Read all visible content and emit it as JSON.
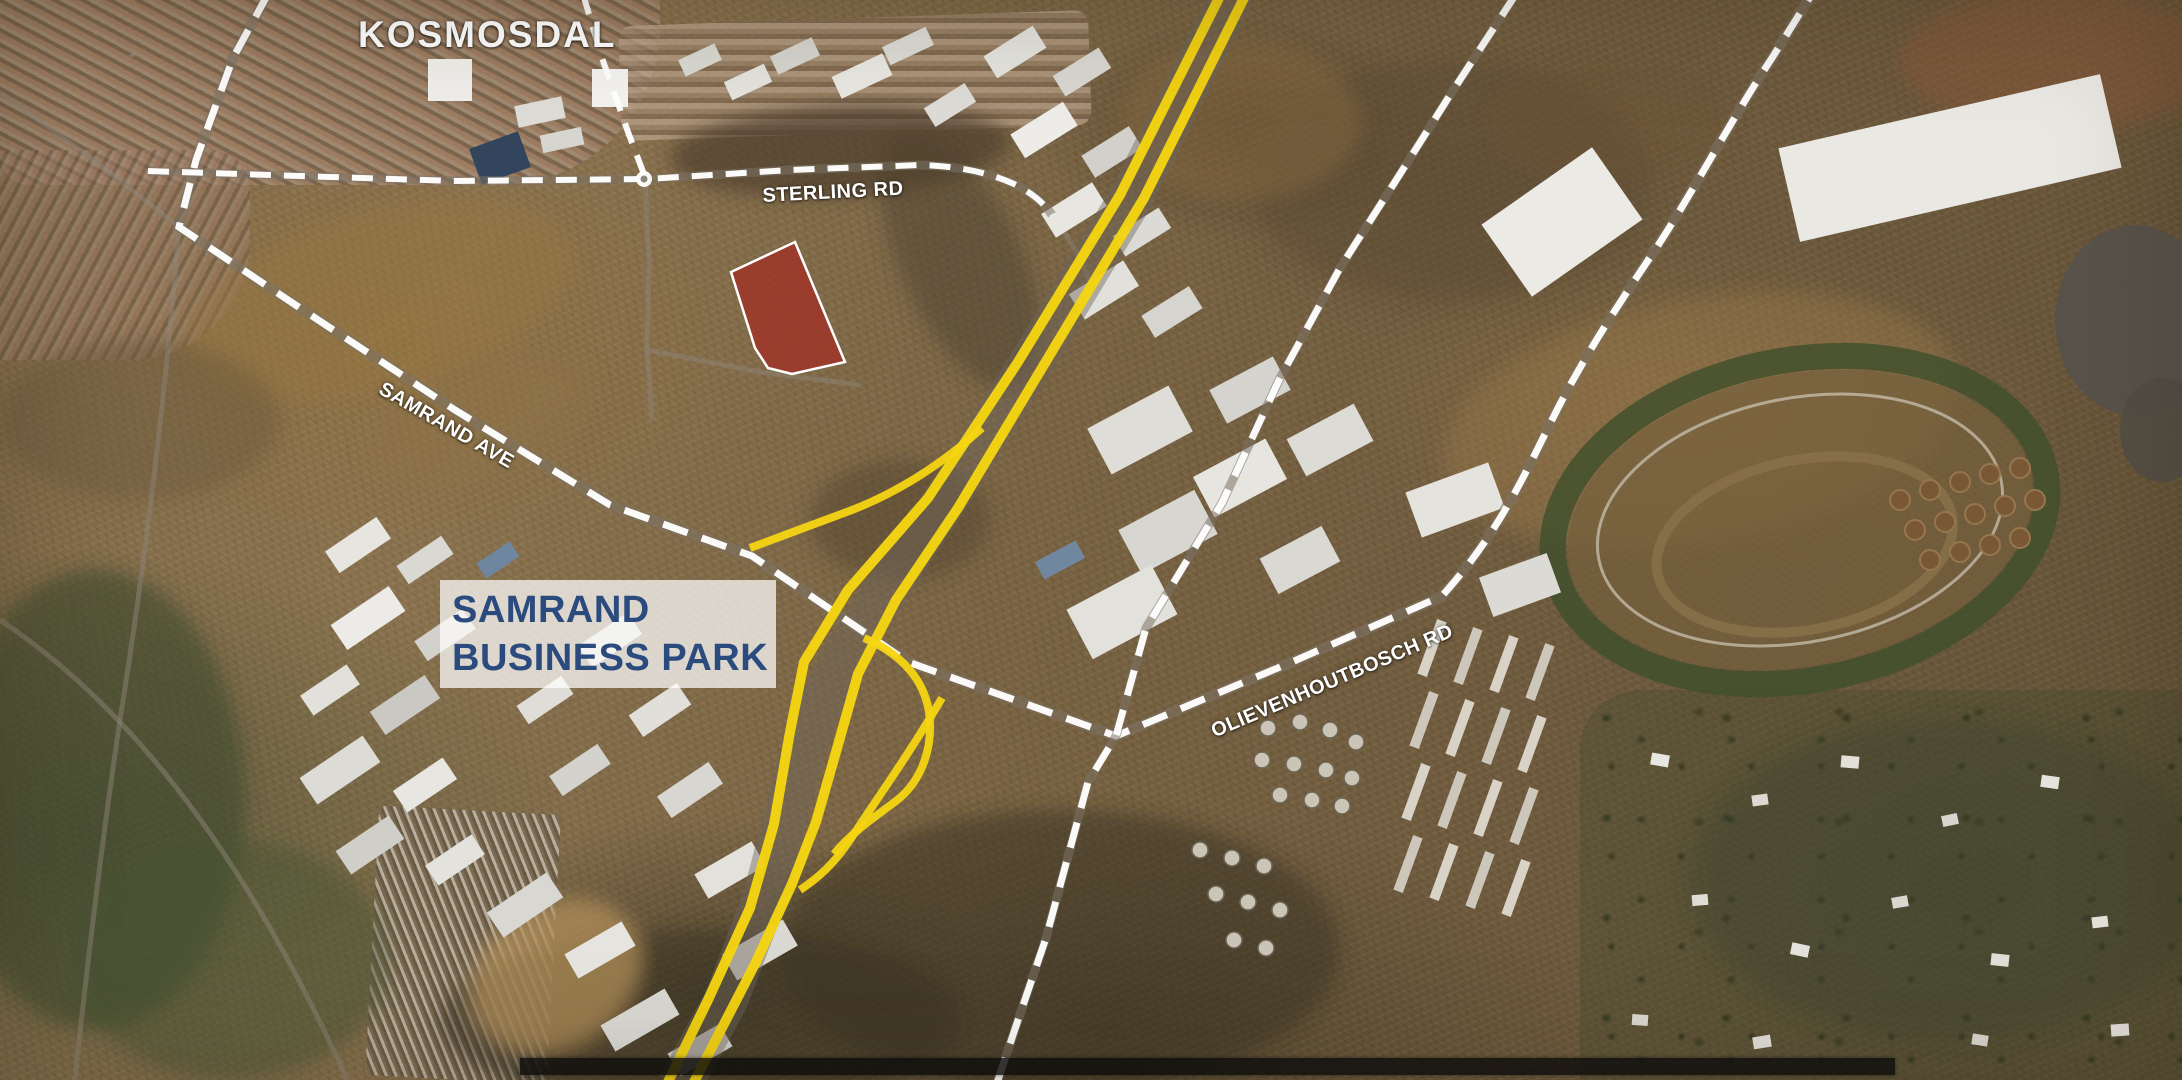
{
  "map": {
    "labels": {
      "kosmosdal": "KOSMOSDAL",
      "sterling_rd": "STERLING RD",
      "samrand_ave": "SAMRAND AVE",
      "olievenhoutbosch_rd": "OLIEVENHOUTBOSCH RD",
      "business_park_line1": "SAMRAND",
      "business_park_line2": "BUSINESS PARK"
    },
    "colors": {
      "highway_yellow": "#F5D512",
      "road_dash_white": "#FFFFFF",
      "site_fill_red": "#A13227",
      "site_border_white": "#FFFFFF",
      "business_park_text_navy": "#2B4A7E",
      "label_white": "#FFFFFF",
      "bottom_bar_black": "#0C0C0C"
    },
    "geometry": {
      "site_polygon": "795,242 845,362 792,374 768,368 755,348 731,272",
      "road_main": "M268,-6 L233,58 L196,160 L179,227 L300,308 L455,410 L610,505 L752,556 L908,662 L1116,736 L1292,662 L1442,596 C1492,540 1515,495 1548,428 C1580,362 1618,305 1655,250 C1692,194 1732,118 1772,58 L1812,-6",
      "road_sterling": "M148,171 L300,176 L455,181 L648,179 L790,170 L920,165 C960,166 990,173 1014,184 C1032,193 1044,203 1052,215",
      "road_north": "M1516,-6 L1452,92 L1400,174 L1340,268 L1280,378 L1222,503 L1146,628 L1116,736 L1088,782 L1046,938 L1016,1026 L996,1086",
      "road_d": "M583,-6 L602,58 L628,132 L645,177",
      "n1_under": "M1234,-8 L1132,196 L1030,365 L944,502 C900,570 865,620 840,665 C815,710 800,760 790,800 L764,900 L726,1000 L679,1086",
      "n1_west": "M1222,-8 L1120,195 L1018,362 L928,498 L848,590 L804,662 L790,732 L774,824 L750,908 L708,1000 L666,1086",
      "n1_east": "M1247,-8 L1144,198 L1042,368 L958,508 L896,600 L858,674 L836,752 L816,822 L792,884 L756,962 L692,1086",
      "ramp_west": "M982,428 C940,466 898,492 852,510 C818,523 784,535 750,548",
      "ramp_hook": "M864,638 C902,654 924,680 929,712 C934,748 921,782 896,801 C872,819 850,834 834,854",
      "ramp_se": "M942,698 C908,756 876,800 850,840 C834,864 818,878 800,890",
      "grey1": "M0,92 L100,165 L179,227",
      "grey2": "M179,227 C170,340 152,520 120,720 C102,840 88,960 74,1086",
      "grey3": "M645,177 L649,265 L647,350 L652,420",
      "grey4": "M647,350 L760,372 L860,385",
      "grey5": "M0,620 C120,700 240,840 350,1086",
      "grey6": "M1052,215 C1075,245 1090,275 1098,310"
    },
    "buildings": {
      "industrial": [
        [
          358,
          545,
          62,
          26,
          -34,
          "#e6e5e0"
        ],
        [
          425,
          560,
          54,
          22,
          -34,
          "#d9d8d2"
        ],
        [
          368,
          618,
          70,
          30,
          -34,
          "#ecebe7"
        ],
        [
          445,
          635,
          58,
          24,
          -34,
          "#d2d1cb"
        ],
        [
          330,
          690,
          56,
          24,
          -34,
          "#e1e0da"
        ],
        [
          405,
          705,
          66,
          28,
          -34,
          "#c9c8c2"
        ],
        [
          340,
          770,
          76,
          32,
          -34,
          "#dcdbd5"
        ],
        [
          425,
          785,
          60,
          26,
          -34,
          "#e7e6e1"
        ],
        [
          370,
          845,
          64,
          28,
          -34,
          "#cfcec8"
        ],
        [
          455,
          860,
          56,
          24,
          -34,
          "#e3e2dd"
        ],
        [
          498,
          560,
          40,
          18,
          -34,
          "#6e86a0"
        ],
        [
          545,
          700,
          54,
          22,
          -34,
          "#deddd7"
        ],
        [
          580,
          770,
          58,
          24,
          -34,
          "#d3d2cc"
        ],
        [
          610,
          640,
          60,
          26,
          -34,
          "#d5d4ce"
        ],
        [
          660,
          710,
          58,
          26,
          -34,
          "#e0dfd9"
        ],
        [
          690,
          790,
          62,
          26,
          -34,
          "#d7d6d0"
        ],
        [
          730,
          870,
          66,
          28,
          -30,
          "#e2e1dc"
        ],
        [
          760,
          950,
          70,
          30,
          -30,
          "#d9d8d2"
        ],
        [
          525,
          905,
          72,
          30,
          -34,
          "#d8d7d1"
        ],
        [
          600,
          950,
          66,
          28,
          -30,
          "#e5e4df"
        ],
        [
          640,
          1020,
          74,
          30,
          -30,
          "#dad9d3"
        ],
        [
          700,
          1050,
          60,
          26,
          -30,
          "#d1d0ca"
        ],
        [
          450,
          80,
          44,
          42,
          0,
          "#efeeea"
        ],
        [
          610,
          88,
          36,
          38,
          0,
          "#f3f2ee"
        ],
        [
          540,
          112,
          48,
          22,
          -12,
          "#dddcd6"
        ],
        [
          562,
          140,
          42,
          18,
          -12,
          "#d6d5cf"
        ],
        [
          500,
          158,
          52,
          38,
          -20,
          "#32455c"
        ],
        [
          700,
          60,
          40,
          18,
          -25,
          "#d9d8d2"
        ],
        [
          748,
          82,
          44,
          20,
          -25,
          "#e4e3de"
        ],
        [
          795,
          56,
          46,
          20,
          -25,
          "#d5d4ce"
        ],
        [
          862,
          76,
          56,
          24,
          -25,
          "#e8e7e2"
        ],
        [
          908,
          46,
          48,
          20,
          -25,
          "#dcdbd5"
        ],
        [
          1015,
          52,
          58,
          26,
          -32,
          "#e4e3de"
        ],
        [
          1082,
          72,
          54,
          24,
          -32,
          "#d8d7d1"
        ],
        [
          1044,
          130,
          62,
          28,
          -32,
          "#edece8"
        ],
        [
          1112,
          152,
          56,
          26,
          -32,
          "#d1d0ca"
        ],
        [
          1074,
          210,
          60,
          28,
          -32,
          "#e7e6e1"
        ],
        [
          1142,
          232,
          54,
          24,
          -32,
          "#dbdad4"
        ],
        [
          1104,
          290,
          64,
          30,
          -32,
          "#e1e0db"
        ],
        [
          1172,
          312,
          56,
          26,
          -32,
          "#d5d4cf"
        ],
        [
          950,
          105,
          48,
          22,
          -32,
          "#dcdbd5"
        ],
        [
          1140,
          430,
          92,
          52,
          -28,
          "#deddd7"
        ],
        [
          1240,
          478,
          82,
          46,
          -28,
          "#e6e5e0"
        ],
        [
          1168,
          532,
          86,
          50,
          -28,
          "#d7d6d0"
        ],
        [
          1122,
          612,
          96,
          56,
          -28,
          "#e2e1dc"
        ],
        [
          1250,
          390,
          72,
          38,
          -28,
          "#d4d3cd"
        ],
        [
          1330,
          440,
          76,
          42,
          -28,
          "#dcdbd5"
        ],
        [
          1300,
          560,
          70,
          40,
          -28,
          "#d9d8d2"
        ],
        [
          1060,
          560,
          46,
          20,
          -28,
          "#70889f"
        ],
        [
          1562,
          222,
          135,
          88,
          -35,
          "#eceae5"
        ],
        [
          1950,
          158,
          330,
          96,
          -13,
          "#eae8e3"
        ],
        [
          1455,
          500,
          88,
          48,
          -20,
          "#e5e3de"
        ],
        [
          1520,
          585,
          72,
          42,
          -20,
          "#dcdad5"
        ],
        [
          1660,
          760,
          18,
          12,
          10,
          "#e8e6e0"
        ],
        [
          1760,
          800,
          16,
          11,
          -8,
          "#ddd9d2"
        ],
        [
          1850,
          762,
          18,
          12,
          5,
          "#e3e0da"
        ],
        [
          1950,
          820,
          16,
          11,
          -12,
          "#d8d5ce"
        ],
        [
          2050,
          782,
          18,
          12,
          8,
          "#e6e3dd"
        ],
        [
          1700,
          900,
          16,
          11,
          -5,
          "#dfdcd5"
        ],
        [
          1800,
          950,
          18,
          12,
          12,
          "#e4e1db"
        ],
        [
          1900,
          902,
          16,
          11,
          -10,
          "#dad7d0"
        ],
        [
          2000,
          960,
          18,
          12,
          6,
          "#e1ded8"
        ],
        [
          2100,
          922,
          16,
          11,
          -7,
          "#e7e4de"
        ],
        [
          1640,
          1020,
          16,
          11,
          4,
          "#dcd9d2"
        ],
        [
          1762,
          1042,
          18,
          12,
          -9,
          "#e2dfd9"
        ],
        [
          1980,
          1040,
          16,
          11,
          9,
          "#d9d6cf"
        ],
        [
          2120,
          1030,
          18,
          12,
          -4,
          "#e5e2dc"
        ],
        [
          1432,
          648,
          10,
          58,
          20,
          "#d9d3c7"
        ],
        [
          1468,
          656,
          10,
          58,
          20,
          "#cdc7bb"
        ],
        [
          1504,
          664,
          10,
          58,
          20,
          "#d9d3c7"
        ],
        [
          1540,
          672,
          10,
          58,
          20,
          "#cdc7bb"
        ],
        [
          1424,
          720,
          10,
          58,
          20,
          "#cdc7bb"
        ],
        [
          1460,
          728,
          10,
          58,
          20,
          "#d9d3c7"
        ],
        [
          1496,
          736,
          10,
          58,
          20,
          "#cdc7bb"
        ],
        [
          1532,
          744,
          10,
          58,
          20,
          "#d9d3c7"
        ],
        [
          1416,
          792,
          10,
          58,
          20,
          "#d9d3c7"
        ],
        [
          1452,
          800,
          10,
          58,
          20,
          "#cdc7bb"
        ],
        [
          1488,
          808,
          10,
          58,
          20,
          "#d9d3c7"
        ],
        [
          1524,
          816,
          10,
          58,
          20,
          "#cdc7bb"
        ],
        [
          1408,
          864,
          10,
          58,
          20,
          "#cdc7bb"
        ],
        [
          1444,
          872,
          10,
          58,
          20,
          "#d9d3c7"
        ],
        [
          1480,
          880,
          10,
          58,
          20,
          "#cdc7bb"
        ],
        [
          1516,
          888,
          10,
          58,
          20,
          "#d9d3c7"
        ]
      ],
      "huts": [
        [
          1268,
          728
        ],
        [
          1300,
          722
        ],
        [
          1330,
          730
        ],
        [
          1356,
          742
        ],
        [
          1262,
          760
        ],
        [
          1294,
          764
        ],
        [
          1326,
          770
        ],
        [
          1352,
          778
        ],
        [
          1280,
          795
        ],
        [
          1312,
          800
        ],
        [
          1342,
          806
        ],
        [
          1200,
          850
        ],
        [
          1232,
          858
        ],
        [
          1264,
          866
        ],
        [
          1216,
          894
        ],
        [
          1248,
          902
        ],
        [
          1280,
          910
        ],
        [
          1234,
          940
        ],
        [
          1266,
          948
        ]
      ],
      "tanks": [
        [
          1900,
          500
        ],
        [
          1930,
          490
        ],
        [
          1960,
          482
        ],
        [
          1990,
          474
        ],
        [
          2020,
          468
        ],
        [
          1915,
          530
        ],
        [
          1945,
          522
        ],
        [
          1975,
          514
        ],
        [
          2005,
          506
        ],
        [
          2035,
          500
        ],
        [
          1930,
          560
        ],
        [
          1960,
          552
        ],
        [
          1990,
          545
        ],
        [
          2020,
          538
        ]
      ]
    },
    "terrain_patches": [
      [
        840,
        150,
        170,
        45,
        -3,
        "#4a3b28",
        0.65
      ],
      [
        380,
        300,
        200,
        90,
        -15,
        "#96753f",
        0.5
      ],
      [
        95,
        800,
        150,
        230,
        0,
        "#3e4a2c",
        0.6
      ],
      [
        230,
        960,
        160,
        120,
        0,
        "#46512f",
        0.5
      ],
      [
        700,
        1020,
        260,
        90,
        0,
        "#35301f",
        0.5
      ],
      [
        1060,
        950,
        280,
        140,
        0,
        "#3a3423",
        0.5
      ],
      [
        1700,
        420,
        260,
        120,
        -10,
        "#9a7a4c",
        0.4
      ],
      [
        1450,
        180,
        200,
        120,
        0,
        "#5c4930",
        0.45
      ],
      [
        1240,
        120,
        120,
        80,
        0,
        "#8a6c42",
        0.45
      ],
      [
        1950,
        880,
        260,
        160,
        0,
        "#3f472c",
        0.4
      ],
      [
        556,
        975,
        90,
        70,
        -33,
        "#b08d5a",
        0.75
      ],
      [
        900,
        520,
        90,
        60,
        0,
        "#4e3e2a",
        0.45
      ],
      [
        2060,
        60,
        160,
        70,
        0,
        "#8a5736",
        0.5
      ],
      [
        960,
        260,
        60,
        140,
        -25,
        "#4c4030",
        0.5
      ],
      [
        140,
        420,
        140,
        80,
        0,
        "#6b5a3c",
        0.5
      ],
      [
        480,
        420,
        120,
        60,
        -20,
        "#8d7148",
        0.5
      ],
      [
        1610,
        120,
        120,
        60,
        0,
        "#6b5438",
        0.45
      ]
    ]
  }
}
